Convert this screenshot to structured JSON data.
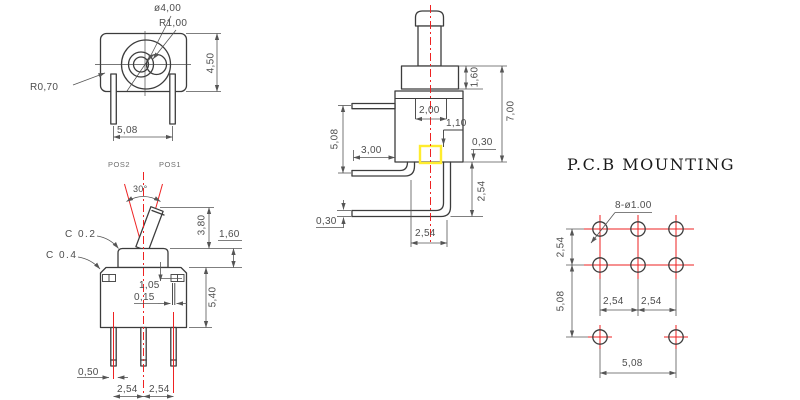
{
  "colors": {
    "outline": "#3c3c3c",
    "dimension": "#555555",
    "centerline_red": "#ee2222",
    "highlight_yellow": "#ffec2e",
    "background": "#ffffff"
  },
  "top_view": {
    "labels": {
      "hole_diameter": "ø4,00",
      "lever_radius": "R1,00",
      "corner_radius": "R0,70",
      "body_depth": "4,50",
      "pin_spacing": "5,08"
    }
  },
  "front_view": {
    "labels": {
      "position_left": "POS2",
      "position_right": "POS1",
      "throw_angle": "30°",
      "lever_length": "3,80",
      "bushing_height": "1,60",
      "chamfer_bushing": "C 0.2",
      "chamfer_body": "C 0.4",
      "slot_offset": "1,05",
      "slot_width": "0,15",
      "body_height": "5,40",
      "pin_thickness": "0,50",
      "pin_pitch_left": "2,54",
      "pin_pitch_right": "2,54"
    }
  },
  "side_view": {
    "labels": {
      "bushing_height": "1,60",
      "overall_height": "7,00",
      "actuator_slot": "2,00",
      "inner_step": "1,10",
      "pin_row_spacing": "5,08",
      "pin_protrusion": "3,00",
      "pin_thickness_upper": "0,30",
      "pin_thickness_lower": "0,30",
      "bend_spacing": "2,54",
      "row_drop": "2,54"
    }
  },
  "pcb_view": {
    "title": "P.C.B MOUNTING",
    "labels": {
      "hole_callout": "8-ø1.00",
      "row_pitch": "2,54",
      "row_span": "5,08",
      "col_pitch_left": "2,54",
      "col_pitch_right": "2,54",
      "col_span": "5,08"
    }
  }
}
